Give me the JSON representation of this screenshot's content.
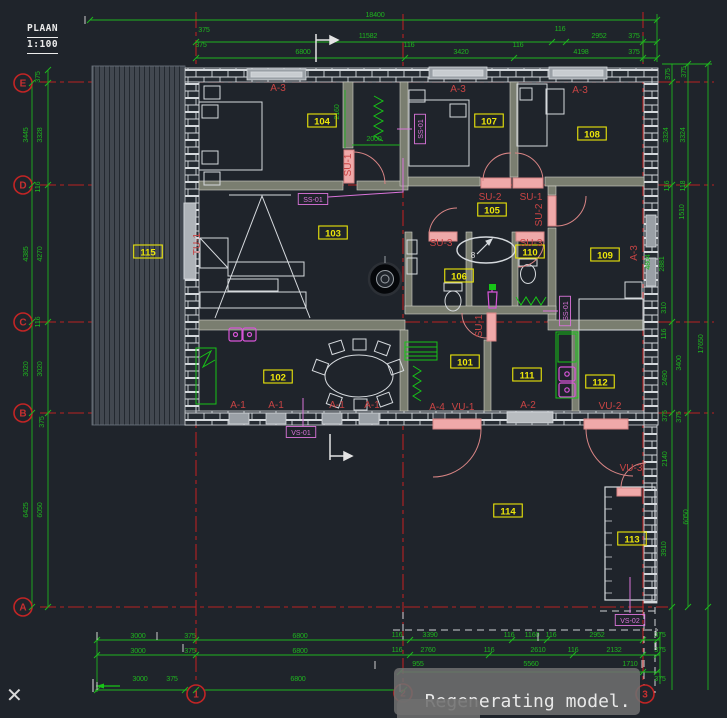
{
  "window": {
    "width": 727,
    "height": 718,
    "bg": "#1f242b"
  },
  "ui": {
    "title_line1": "PLAAN",
    "title_line2": "1:100",
    "overlay_line1": "Regenerating model.",
    "overlay_line2": "plot",
    "close_icon": "✕"
  },
  "colors": {
    "dim_green": "#1fb41f",
    "axis_red": "#b82222",
    "tag_red": "#c84444",
    "room_yellow": "#ece60a",
    "magenta": "#da74da",
    "wall_white": "#d6dade",
    "door_pink": "#efa9a9",
    "bg": "#1f242b"
  },
  "axis_bubbles": [
    {
      "label": "E",
      "x": 23,
      "y": 83
    },
    {
      "label": "D",
      "x": 23,
      "y": 185
    },
    {
      "label": "C",
      "x": 23,
      "y": 322
    },
    {
      "label": "B",
      "x": 23,
      "y": 413
    },
    {
      "label": "A",
      "x": 23,
      "y": 607
    },
    {
      "label": "1",
      "x": 196,
      "y": 694
    },
    {
      "label": "2",
      "x": 403,
      "y": 693
    },
    {
      "label": "3",
      "x": 645,
      "y": 694
    }
  ],
  "room_labels": [
    {
      "t": "101",
      "x": 465,
      "y": 362
    },
    {
      "t": "102",
      "x": 278,
      "y": 377
    },
    {
      "t": "103",
      "x": 333,
      "y": 233
    },
    {
      "t": "104",
      "x": 322,
      "y": 121
    },
    {
      "t": "105",
      "x": 492,
      "y": 210
    },
    {
      "t": "106",
      "x": 459,
      "y": 276
    },
    {
      "t": "107",
      "x": 489,
      "y": 121
    },
    {
      "t": "108",
      "x": 592,
      "y": 134
    },
    {
      "t": "109",
      "x": 605,
      "y": 255
    },
    {
      "t": "110",
      "x": 530,
      "y": 252
    },
    {
      "t": "111",
      "x": 527,
      "y": 375
    },
    {
      "t": "112",
      "x": 600,
      "y": 382
    },
    {
      "t": "113",
      "x": 632,
      "y": 539
    },
    {
      "t": "114",
      "x": 508,
      "y": 511
    },
    {
      "t": "115",
      "x": 148,
      "y": 252
    }
  ],
  "red_tags": [
    {
      "t": "A-3",
      "x": 278,
      "y": 91
    },
    {
      "t": "A-3",
      "x": 458,
      "y": 92
    },
    {
      "t": "A-3",
      "x": 580,
      "y": 93
    },
    {
      "t": "A-3",
      "x": 637,
      "y": 253,
      "r": -90
    },
    {
      "t": "SU-2",
      "x": 490,
      "y": 200
    },
    {
      "t": "SU-1",
      "x": 531,
      "y": 200
    },
    {
      "t": "SU-3",
      "x": 441,
      "y": 246
    },
    {
      "t": "SU-3",
      "x": 531,
      "y": 246
    },
    {
      "t": "SU-1",
      "x": 351,
      "y": 165,
      "r": -90
    },
    {
      "t": "SU-1",
      "x": 482,
      "y": 326,
      "r": -90
    },
    {
      "t": "SU-2",
      "x": 542,
      "y": 215,
      "r": -90
    },
    {
      "t": "TU-1",
      "x": 200,
      "y": 244,
      "r": -90
    },
    {
      "t": "A-1",
      "x": 238,
      "y": 408
    },
    {
      "t": "A-1",
      "x": 276,
      "y": 408
    },
    {
      "t": "A-1",
      "x": 337,
      "y": 408
    },
    {
      "t": "A-1",
      "x": 372,
      "y": 408
    },
    {
      "t": "A-4",
      "x": 437,
      "y": 410
    },
    {
      "t": "VU-1",
      "x": 463,
      "y": 410
    },
    {
      "t": "A-2",
      "x": 528,
      "y": 408
    },
    {
      "t": "VU-2",
      "x": 610,
      "y": 409
    },
    {
      "t": "VU-3",
      "x": 631,
      "y": 471
    }
  ],
  "magenta_tags": [
    {
      "t": "SS-01",
      "x": 313,
      "y": 199,
      "leader": [
        [
          403,
          158
        ],
        [
          403,
          192
        ],
        [
          328,
          197
        ]
      ]
    },
    {
      "t": "SS-01",
      "x": 420,
      "y": 129,
      "r": -90,
      "leader": [
        [
          412,
          129
        ],
        [
          397,
          129
        ]
      ]
    },
    {
      "t": "SS-01",
      "x": 565,
      "y": 311,
      "r": -90,
      "leader": [
        [
          558,
          311
        ],
        [
          543,
          311
        ]
      ]
    },
    {
      "t": "VS-01",
      "x": 301,
      "y": 432,
      "leader": [
        [
          303,
          426
        ],
        [
          303,
          398
        ]
      ]
    },
    {
      "t": "VS-02",
      "x": 630,
      "y": 620,
      "leader": [
        [
          630,
          613
        ],
        [
          630,
          577
        ]
      ]
    }
  ],
  "white_texts": [
    {
      "t": "8",
      "x": 473,
      "y": 258
    }
  ],
  "dim_texts": [
    {
      "t": "18400",
      "x": 375,
      "y": 17
    },
    {
      "t": "375",
      "x": 204,
      "y": 32
    },
    {
      "t": "11582",
      "x": 368,
      "y": 38
    },
    {
      "t": "116",
      "x": 560,
      "y": 31
    },
    {
      "t": "2952",
      "x": 599,
      "y": 38
    },
    {
      "t": "375",
      "x": 634,
      "y": 38
    },
    {
      "t": "375",
      "x": 201,
      "y": 47
    },
    {
      "t": "6800",
      "x": 303,
      "y": 54
    },
    {
      "t": "116",
      "x": 409,
      "y": 47
    },
    {
      "t": "3420",
      "x": 461,
      "y": 54
    },
    {
      "t": "116",
      "x": 518,
      "y": 47
    },
    {
      "t": "4198",
      "x": 581,
      "y": 54
    },
    {
      "t": "375",
      "x": 634,
      "y": 54
    },
    {
      "t": "2160",
      "x": 339,
      "y": 112,
      "r": -90
    },
    {
      "t": "2000",
      "x": 374,
      "y": 141
    },
    {
      "t": "375",
      "x": 40,
      "y": 77,
      "r": -90
    },
    {
      "t": "3445",
      "x": 28,
      "y": 135,
      "r": -90
    },
    {
      "t": "3328",
      "x": 42,
      "y": 135,
      "r": -90
    },
    {
      "t": "116",
      "x": 40,
      "y": 187,
      "r": -90
    },
    {
      "t": "4385",
      "x": 28,
      "y": 254,
      "r": -90
    },
    {
      "t": "4270",
      "x": 42,
      "y": 254,
      "r": -90
    },
    {
      "t": "116",
      "x": 40,
      "y": 322,
      "r": -90
    },
    {
      "t": "3020",
      "x": 28,
      "y": 369,
      "r": -90
    },
    {
      "t": "3020",
      "x": 42,
      "y": 369,
      "r": -90
    },
    {
      "t": "375",
      "x": 44,
      "y": 422,
      "r": -90
    },
    {
      "t": "6425",
      "x": 28,
      "y": 510,
      "r": -90
    },
    {
      "t": "6050",
      "x": 42,
      "y": 510,
      "r": -90
    },
    {
      "t": "375",
      "x": 670,
      "y": 74,
      "r": -90
    },
    {
      "t": "375",
      "x": 686,
      "y": 72,
      "r": -90
    },
    {
      "t": "3324",
      "x": 668,
      "y": 135,
      "r": -90
    },
    {
      "t": "3324",
      "x": 685,
      "y": 135,
      "r": -90
    },
    {
      "t": "116",
      "x": 669,
      "y": 186,
      "r": -90
    },
    {
      "t": "118",
      "x": 685,
      "y": 186,
      "r": -90
    },
    {
      "t": "1510",
      "x": 684,
      "y": 212,
      "r": -90
    },
    {
      "t": "4804",
      "x": 650,
      "y": 262,
      "r": -90
    },
    {
      "t": "2881",
      "x": 664,
      "y": 264,
      "r": -90
    },
    {
      "t": "310",
      "x": 666,
      "y": 308,
      "r": -90
    },
    {
      "t": "116",
      "x": 666,
      "y": 334,
      "r": -90
    },
    {
      "t": "3400",
      "x": 681,
      "y": 363,
      "r": -90
    },
    {
      "t": "17650",
      "x": 703,
      "y": 344,
      "r": -90
    },
    {
      "t": "2490",
      "x": 667,
      "y": 378,
      "r": -90
    },
    {
      "t": "375",
      "x": 667,
      "y": 416,
      "r": -90
    },
    {
      "t": "375",
      "x": 681,
      "y": 417,
      "r": -90
    },
    {
      "t": "2140",
      "x": 667,
      "y": 459,
      "r": -90
    },
    {
      "t": "3910",
      "x": 666,
      "y": 549,
      "r": -90
    },
    {
      "t": "6050",
      "x": 688,
      "y": 517,
      "r": -90
    },
    {
      "t": "3000",
      "x": 138,
      "y": 638
    },
    {
      "t": "375",
      "x": 190,
      "y": 638
    },
    {
      "t": "6800",
      "x": 300,
      "y": 638
    },
    {
      "t": "3000",
      "x": 138,
      "y": 653
    },
    {
      "t": "375",
      "x": 190,
      "y": 653
    },
    {
      "t": "6800",
      "x": 300,
      "y": 653
    },
    {
      "t": "3000",
      "x": 140,
      "y": 681
    },
    {
      "t": "375",
      "x": 172,
      "y": 681
    },
    {
      "t": "6800",
      "x": 298,
      "y": 681
    },
    {
      "t": "116",
      "x": 397,
      "y": 637
    },
    {
      "t": "3390",
      "x": 430,
      "y": 637
    },
    {
      "t": "116",
      "x": 509,
      "y": 637
    },
    {
      "t": "1160",
      "x": 532,
      "y": 637
    },
    {
      "t": "116",
      "x": 551,
      "y": 637
    },
    {
      "t": "2952",
      "x": 597,
      "y": 637
    },
    {
      "t": "375",
      "x": 660,
      "y": 637
    },
    {
      "t": "116",
      "x": 397,
      "y": 652
    },
    {
      "t": "2760",
      "x": 428,
      "y": 652
    },
    {
      "t": "116",
      "x": 489,
      "y": 652
    },
    {
      "t": "2610",
      "x": 538,
      "y": 652
    },
    {
      "t": "116",
      "x": 573,
      "y": 652
    },
    {
      "t": "2132",
      "x": 614,
      "y": 652
    },
    {
      "t": "375",
      "x": 660,
      "y": 652
    },
    {
      "t": "955",
      "x": 418,
      "y": 666
    },
    {
      "t": "5560",
      "x": 531,
      "y": 666
    },
    {
      "t": "1710",
      "x": 630,
      "y": 666
    },
    {
      "t": "375",
      "x": 660,
      "y": 681
    }
  ],
  "tick_points": [
    [
      90,
      20
    ],
    [
      657,
      20
    ],
    [
      196,
      42
    ],
    [
      552,
      42
    ],
    [
      566,
      42
    ],
    [
      643,
      42
    ],
    [
      657,
      42
    ],
    [
      196,
      58
    ],
    [
      405,
      58
    ],
    [
      514,
      58
    ],
    [
      643,
      58
    ],
    [
      657,
      58
    ],
    [
      32,
      83
    ],
    [
      32,
      185
    ],
    [
      32,
      322
    ],
    [
      32,
      413
    ],
    [
      32,
      607
    ],
    [
      48,
      70
    ],
    [
      48,
      83
    ],
    [
      48,
      185
    ],
    [
      48,
      322
    ],
    [
      48,
      413
    ],
    [
      48,
      607
    ],
    [
      672,
      82
    ],
    [
      672,
      185
    ],
    [
      672,
      322
    ],
    [
      672,
      413
    ],
    [
      672,
      607
    ],
    [
      688,
      64
    ],
    [
      688,
      185
    ],
    [
      688,
      413
    ],
    [
      688,
      607
    ],
    [
      708,
      64
    ],
    [
      708,
      607
    ],
    [
      97,
      640
    ],
    [
      196,
      640
    ],
    [
      410,
      640
    ],
    [
      512,
      640
    ],
    [
      547,
      640
    ],
    [
      643,
      640
    ],
    [
      657,
      640
    ],
    [
      97,
      655
    ],
    [
      196,
      655
    ],
    [
      410,
      655
    ],
    [
      489,
      655
    ],
    [
      573,
      655
    ],
    [
      643,
      655
    ],
    [
      657,
      655
    ],
    [
      400,
      672
    ],
    [
      643,
      672
    ],
    [
      657,
      672
    ],
    [
      97,
      690
    ],
    [
      185,
      690
    ],
    [
      196,
      690
    ],
    [
      404,
      690
    ]
  ],
  "white_ticks": [
    [
      85,
      20
    ],
    [
      316,
      45
    ],
    [
      97,
      636
    ],
    [
      157,
      636
    ],
    [
      183,
      648
    ],
    [
      375,
      665
    ],
    [
      538,
      637
    ],
    [
      642,
      664
    ],
    [
      400,
      688
    ],
    [
      97,
      686
    ],
    [
      656,
      632
    ],
    [
      656,
      646
    ]
  ]
}
